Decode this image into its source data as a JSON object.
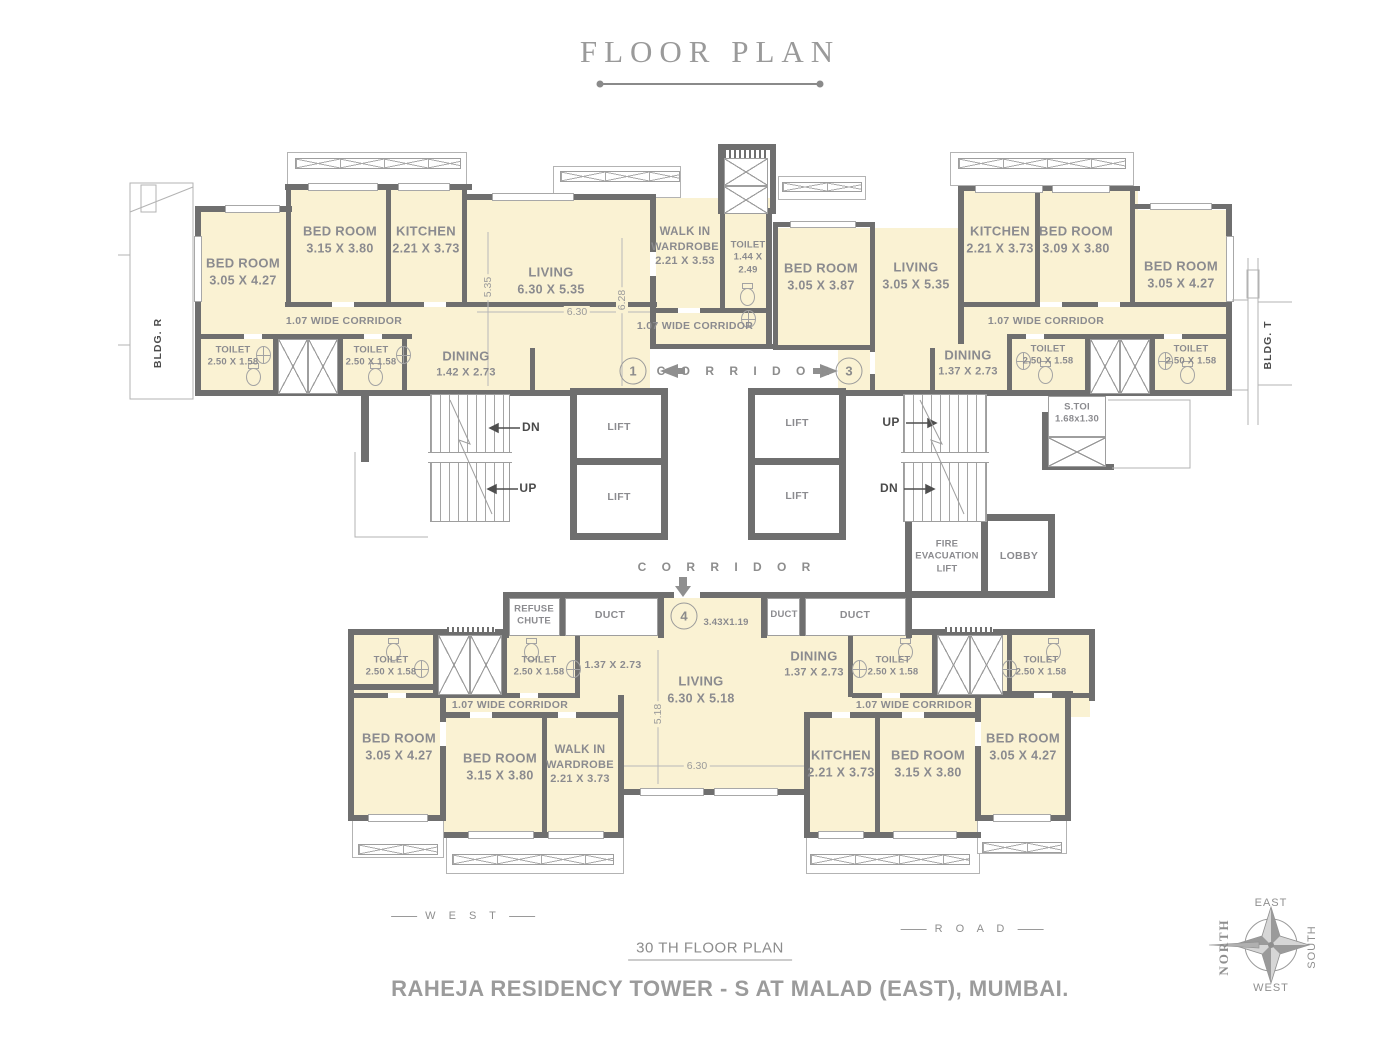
{
  "title": "FLOOR PLAN",
  "footer": {
    "plan_label": "30 TH  FLOOR PLAN",
    "project_title": "RAHEJA RESIDENCY TOWER - S  AT MALAD (EAST), MUMBAI.",
    "west": "W E S T",
    "road": "R O A D"
  },
  "compass": {
    "north": "NORTH",
    "south": "SOUTH",
    "east": "EAST",
    "west": "WEST"
  },
  "adjacent": {
    "left": "BLDG. R",
    "right": "BLDG. T"
  },
  "common": {
    "corridor": "C O R R I D O R",
    "wide_corridor": "1.07 WIDE CORRIDOR",
    "lift": "LIFT",
    "duct": "DUCT",
    "up": "UP",
    "dn": "DN",
    "toilet": "TOILET",
    "toilet_dim": "2.50 X 1.58"
  },
  "core": {
    "fire_lift_1": "FIRE",
    "fire_lift_2": "EVACUATION",
    "fire_lift_3": "LIFT",
    "lobby": "LOBBY",
    "stoi": "S.TOI",
    "stoi_dim": "1.68x1.30",
    "refuse_1": "REFUSE",
    "refuse_2": "CHUTE",
    "entry_dim": "3.43X1.19"
  },
  "units": {
    "u1": "1",
    "u3": "3",
    "u4": "4"
  },
  "dims": {
    "d535": "5.35",
    "d630": "6.30",
    "d628": "6.28",
    "d518": "5.18",
    "d137": "1.37 X 2.73"
  },
  "rooms": {
    "tl_bed1": {
      "n": "BED ROOM",
      "d": "3.05 X 4.27"
    },
    "tl_bed2": {
      "n": "BED ROOM",
      "d": "3.15 X 3.80"
    },
    "tl_kitchen": {
      "n": "KITCHEN",
      "d": "2.21 X 3.73"
    },
    "tl_dining": {
      "n": "DINING",
      "d": "1.42 X 2.73"
    },
    "tl_living": {
      "n": "LIVING",
      "d": "6.30 X 5.35"
    },
    "tl_wiw": {
      "n1": "WALK IN",
      "n2": "WARDROBE",
      "d": "2.21 X 3.53"
    },
    "tl_toilet3": {
      "n": "TOILET",
      "d1": "1.44 X",
      "d2": "2.49"
    },
    "tr_bed1": {
      "n": "BED ROOM",
      "d": "3.05 X 3.87"
    },
    "tr_living": {
      "n": "LIVING",
      "d": "3.05 X 5.35"
    },
    "tr_kitchen": {
      "n": "KITCHEN",
      "d": "2.21 X 3.73"
    },
    "tr_bed2": {
      "n": "BED ROOM",
      "d": "3.09 X 3.80"
    },
    "tr_bed3": {
      "n": "BED ROOM",
      "d": "3.05 X 4.27"
    },
    "tr_dining": {
      "n": "DINING",
      "d": "1.37 X 2.73"
    },
    "b_living": {
      "n": "LIVING",
      "d": "6.30 X 5.18"
    },
    "b_dining": {
      "n": "DINING",
      "d": "1.37 X 2.73"
    },
    "bl_bed1": {
      "n": "BED ROOM",
      "d": "3.05 X 4.27"
    },
    "bl_bed2": {
      "n": "BED ROOM",
      "d": "3.15 X 3.80"
    },
    "bl_wiw": {
      "n1": "WALK IN",
      "n2": "WARDROBE",
      "d": "2.21 X 3.73"
    },
    "br_kitchen": {
      "n": "KITCHEN",
      "d": "2.21 X 3.73"
    },
    "br_bed1": {
      "n": "BED ROOM",
      "d": "3.15 X 3.80"
    },
    "br_bed2": {
      "n": "BED ROOM",
      "d": "3.05 X 4.27"
    }
  }
}
